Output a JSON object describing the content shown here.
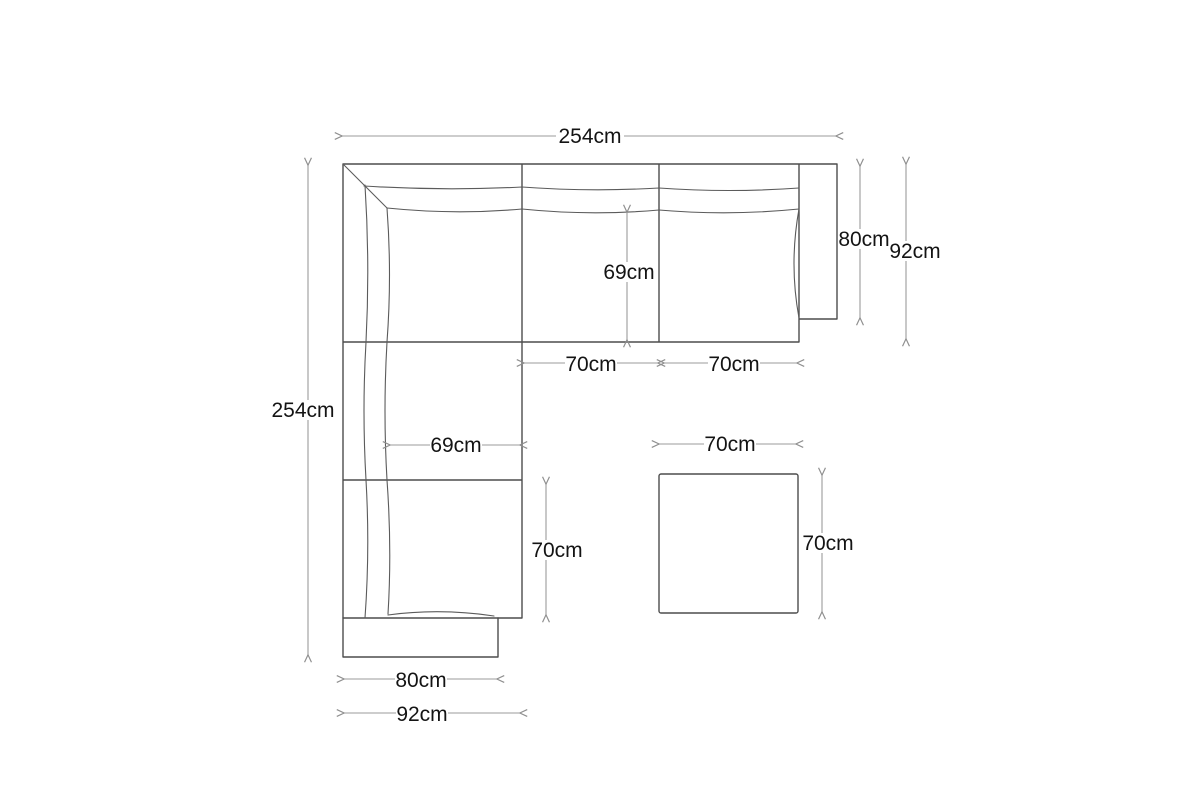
{
  "diagram": {
    "figure": "corner sofa with chaise and square ottoman, top view dimension drawing",
    "unit": "cm",
    "colors": {
      "background": "#ffffff",
      "sofa_outline": "#4d4d4d",
      "dimension_line": "#9b9b9b",
      "label_text": "#141414"
    },
    "labels": {
      "top_total_width": "254cm",
      "left_total_depth": "254cm",
      "right_arm_depth": "80cm",
      "right_overall_depth": "92cm",
      "middle_seat_depth": "69cm",
      "middle_seat_width": "70cm",
      "right_seat_width": "70cm",
      "chaise_seat_width": "69cm",
      "chaise_seat_length": "70cm",
      "ottoman_width": "70cm",
      "ottoman_depth": "70cm",
      "bottom_arm_width": "80cm",
      "bottom_overall_width": "92cm"
    }
  }
}
